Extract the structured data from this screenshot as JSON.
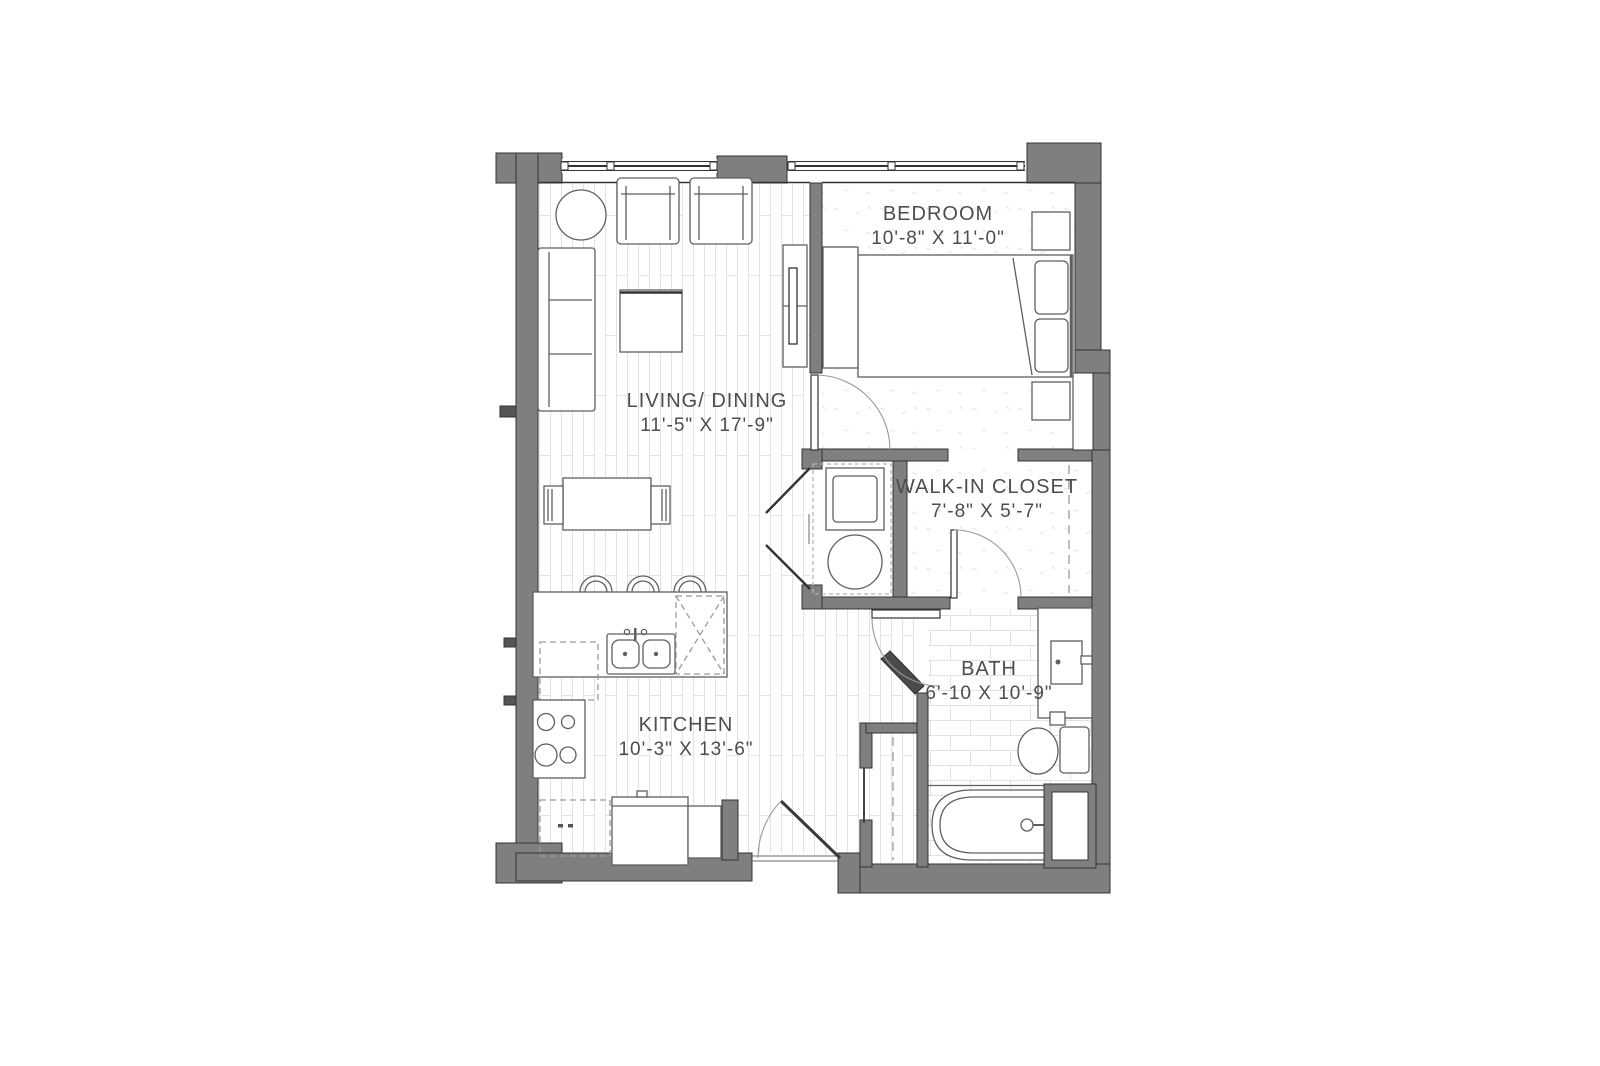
{
  "plan": {
    "rooms": {
      "bedroom": {
        "name": "BEDROOM",
        "dims": "10'-8\" X 11'-0\""
      },
      "living": {
        "name": "LIVING/ DINING",
        "dims": "11'-5\" X 17'-9\""
      },
      "closet": {
        "name": "WALK-IN CLOSET",
        "dims": "7'-8\" X 5'-7\""
      },
      "bath": {
        "name": "BATH",
        "dims": "6'-10 X 10'-9\""
      },
      "kitchen": {
        "name": "KITCHEN",
        "dims": "10'-3\" X 13'-6\""
      }
    },
    "colors": {
      "wall": "#7f7f7f",
      "wall_dark": "#4a4a4a",
      "outline": "#333333",
      "furniture": "#5f5f5f",
      "label": "#4d4d4d",
      "texture": "#e0e0e0",
      "arc": "#9a9a9a"
    }
  }
}
